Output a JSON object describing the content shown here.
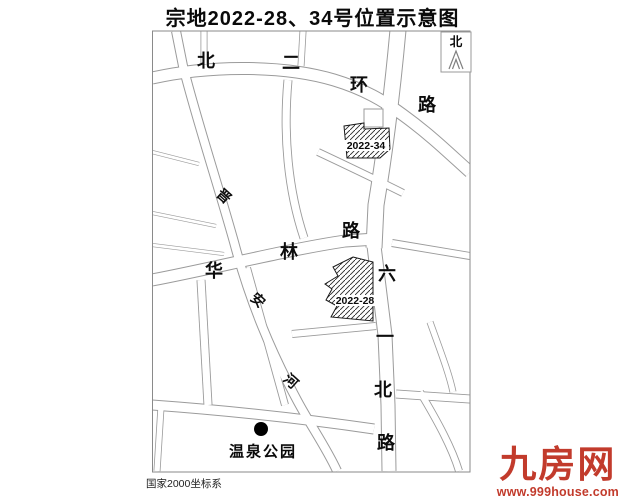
{
  "title": "宗地2022-28、34号位置示意图",
  "map": {
    "north_label": "北",
    "coordinate_system": "国家2000坐标系",
    "park": {
      "name": "温泉公园"
    },
    "roads": [
      {
        "name": "bei-er-huan-road",
        "label": "北二环路",
        "size": 18,
        "rot": 0,
        "chars": [
          {
            "c": "北",
            "x": 206,
            "y": 61
          },
          {
            "c": "二",
            "x": 291,
            "y": 63
          },
          {
            "c": "环",
            "x": 359,
            "y": 85
          },
          {
            "c": "路",
            "x": 427,
            "y": 105
          }
        ]
      },
      {
        "name": "jinan-river",
        "label": "晋安河",
        "size": 14,
        "rot": 42,
        "chars": [
          {
            "c": "晋",
            "x": 224,
            "y": 196
          },
          {
            "c": "安",
            "x": 258,
            "y": 300
          },
          {
            "c": "河",
            "x": 291,
            "y": 381
          }
        ]
      },
      {
        "name": "hualin-road",
        "label": "华林路",
        "size": 18,
        "rot": 0,
        "chars": [
          {
            "c": "华",
            "x": 214,
            "y": 271
          },
          {
            "c": "林",
            "x": 289,
            "y": 252
          },
          {
            "c": "路",
            "x": 351,
            "y": 231
          }
        ]
      },
      {
        "name": "liuyi-north-road",
        "label": "六一北路",
        "size": 18,
        "rot": 0,
        "chars": [
          {
            "c": "六",
            "x": 387,
            "y": 274
          },
          {
            "c": "一",
            "x": 385,
            "y": 337
          },
          {
            "c": "北",
            "x": 383,
            "y": 390
          },
          {
            "c": "路",
            "x": 386,
            "y": 443
          }
        ]
      }
    ],
    "parcels": [
      {
        "label": "2022-34"
      },
      {
        "label": "2022-28"
      }
    ]
  },
  "watermark": {
    "brand": "九房网",
    "website": "www.999house.com",
    "color": "#c23b2c"
  }
}
